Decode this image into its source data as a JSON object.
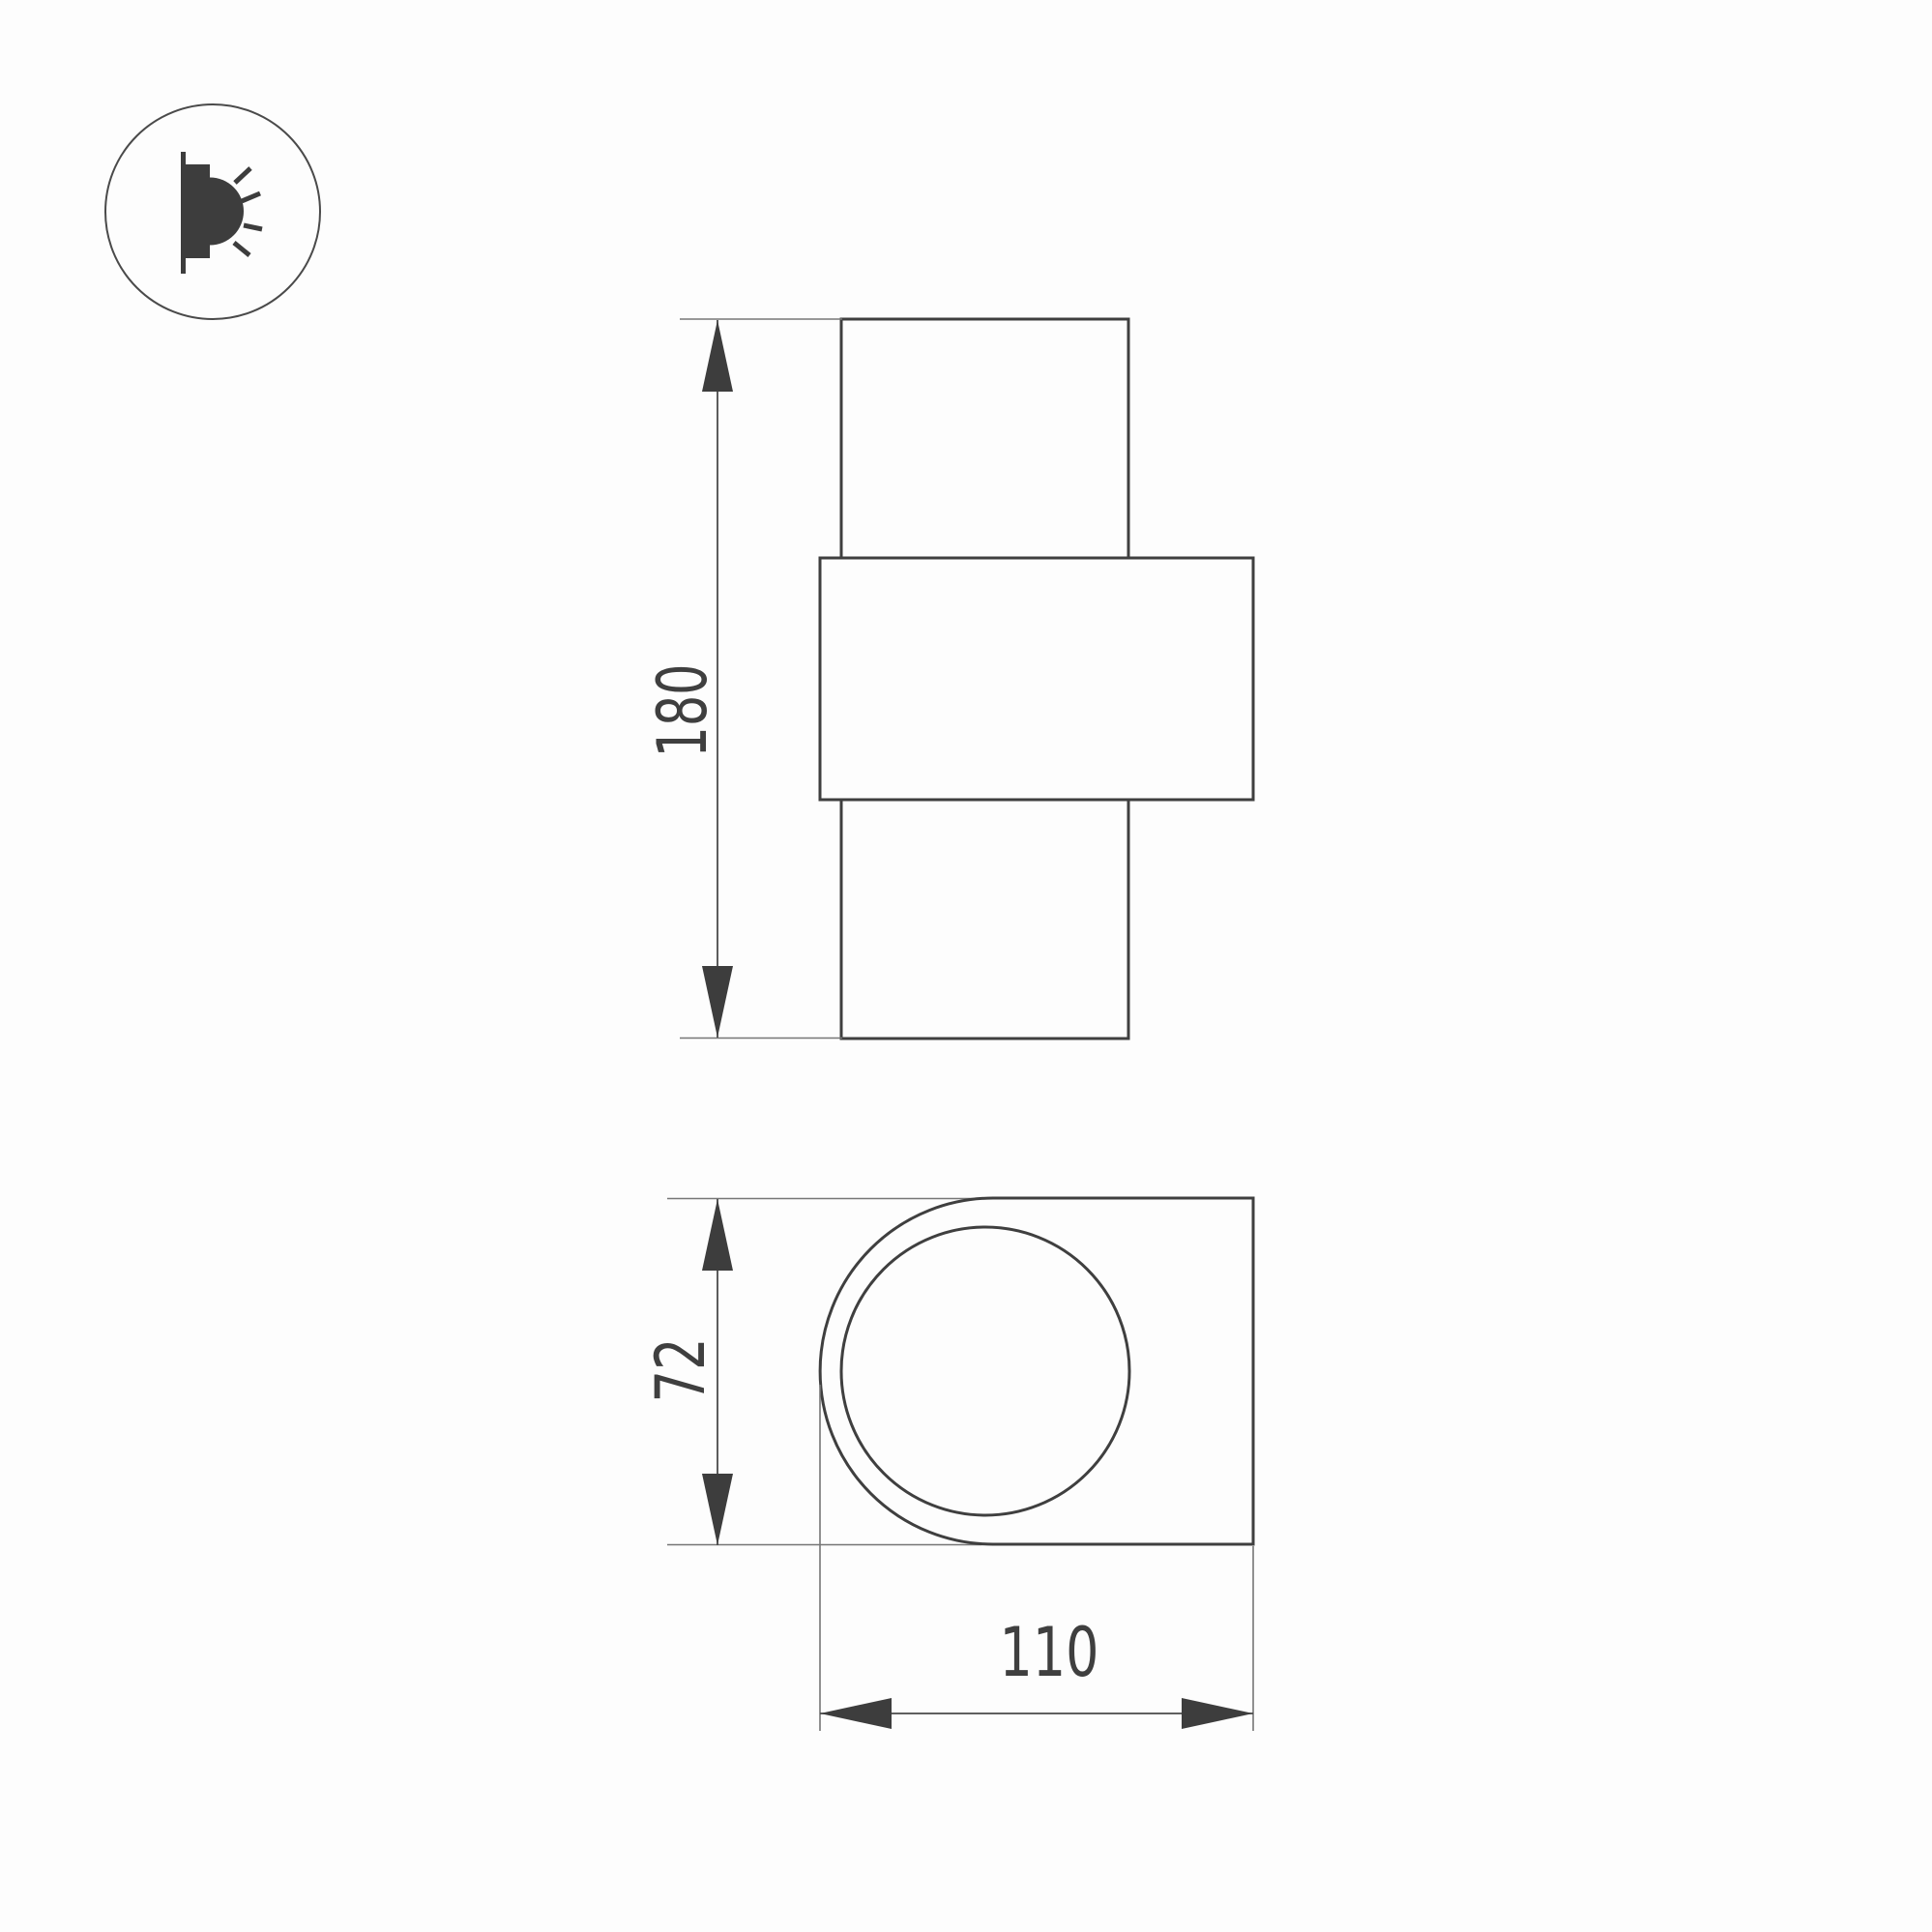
{
  "icon": {
    "name": "wall-mounted-light-direction-icon"
  },
  "front_view": {
    "height_label": "180"
  },
  "side_view": {
    "height_label": "72",
    "width_label": "110"
  },
  "colors": {
    "outline": "#3f3f3f",
    "thinline": "#767676",
    "arrow": "#3d3d3d",
    "textc": "#3f3f3f",
    "paper": "#fdfdfd"
  }
}
